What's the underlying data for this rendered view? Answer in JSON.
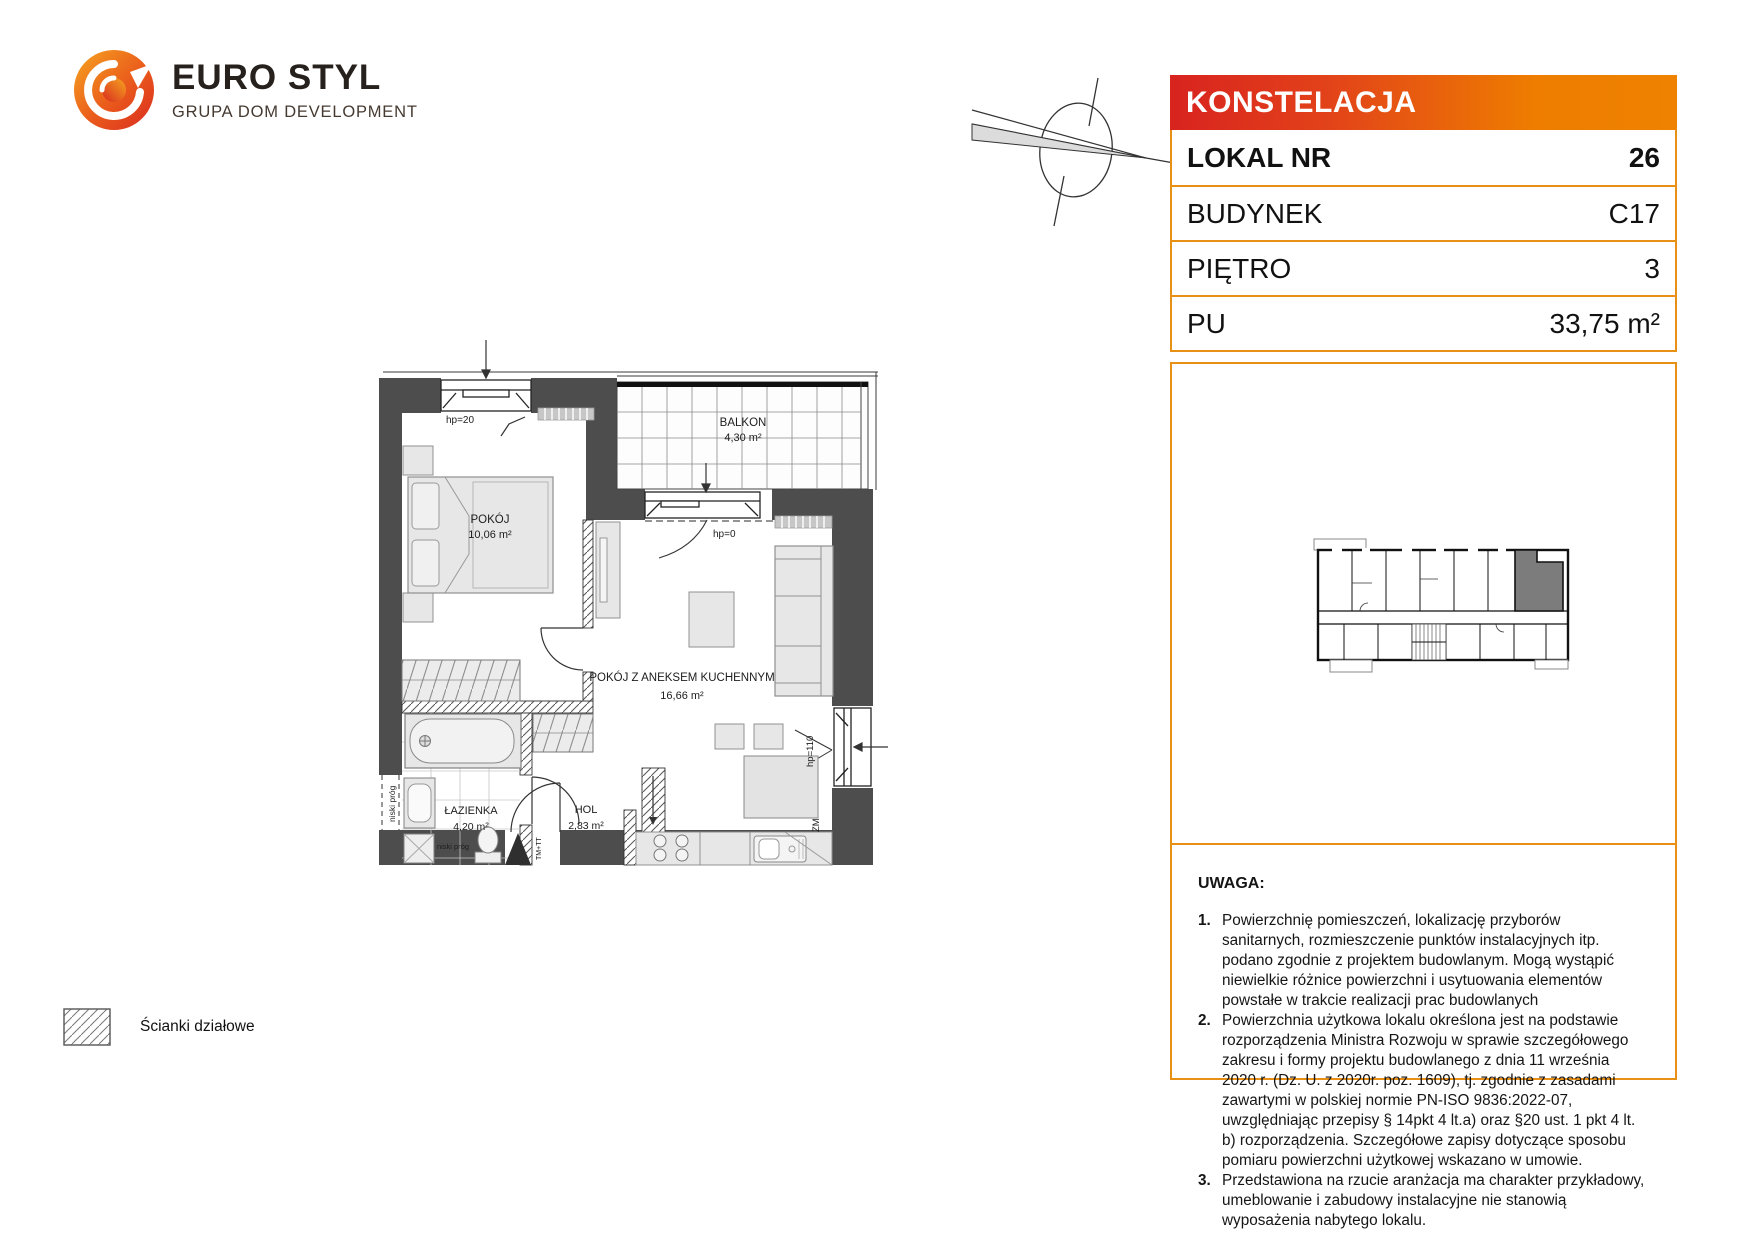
{
  "brand": {
    "name": "EURO STYL",
    "tagline": "GRUPA DOM DEVELOPMENT",
    "logo_icon": "eurostyl-swirl-icon"
  },
  "compass_icon": "north-compass-icon",
  "unit_card": {
    "project": "KONSTELACJA",
    "rows": [
      {
        "label": "LOKAL NR",
        "value": "26"
      },
      {
        "label": "BUDYNEK",
        "value": "C17"
      },
      {
        "label": "PIĘTRO",
        "value": "3"
      },
      {
        "label": "PU",
        "value": "33,75 m²"
      }
    ]
  },
  "floorplan": {
    "rooms": {
      "pokoj": {
        "name": "POKÓJ",
        "area": "10,06 m²"
      },
      "balkon": {
        "name": "BALKON",
        "area": "4,30 m²"
      },
      "pokoj_z_aneksem": {
        "name": "POKÓJ Z ANEKSEM KUCHENNYM",
        "area": "16,66 m²"
      },
      "lazienka": {
        "name": "ŁAZIENKA",
        "area": "4,20 m²"
      },
      "hol": {
        "name": "HOL",
        "area": "2,83 m²"
      }
    },
    "annotations": {
      "hp20": "hp=20",
      "hp0": "hp=0",
      "hp110": "hp=110",
      "zm": "ZM",
      "niski_prog": "niski próg",
      "tm_tt": "TM+TT"
    }
  },
  "notes": {
    "title": "UWAGA:",
    "items": [
      {
        "no": "1.",
        "text": "Powierzchnię pomieszczeń, lokalizację przyborów sanitarnych, rozmieszczenie punktów instalacyjnych itp. podano zgodnie z projektem budowlanym. Mogą wystąpić niewielkie różnice powierzchni i usytuowania elementów powstałe w trakcie realizacji prac budowlanych"
      },
      {
        "no": "2.",
        "text": "Powierzchnia użytkowa lokalu określona jest na podstawie rozporządzenia Ministra Rozwoju w sprawie szczegółowego zakresu i formy projektu budowlanego z dnia 11 września 2020 r. (Dz. U. z 2020r. poz. 1609), tj. zgodnie z zasadami zawartymi w polskiej normie PN-ISO 9836:2022-07, uwzględniając przepisy § 14pkt 4 lt.a) oraz §20 ust. 1 pkt 4 lt. b) rozporządzenia. Szczegółowe zapisy dotyczące sposobu pomiaru powierzchni użytkowej wskazano w umowie."
      },
      {
        "no": "3.",
        "text": "Przedstawiona na rzucie aranżacja ma charakter przykładowy, umeblowanie i zabudowy instalacyjne nie stanowią wyposażenia nabytego lokalu."
      }
    ]
  },
  "legend": {
    "label": "Ścianki działowe",
    "swatch_icon": "partition-hatch-swatch"
  },
  "colors": {
    "accent_red": "#D8231F",
    "accent_orange": "#EE7D00",
    "table_border": "#E89015",
    "wall_gray": "#4D4D4D",
    "highlighted_unit": "#7C7C7C"
  }
}
